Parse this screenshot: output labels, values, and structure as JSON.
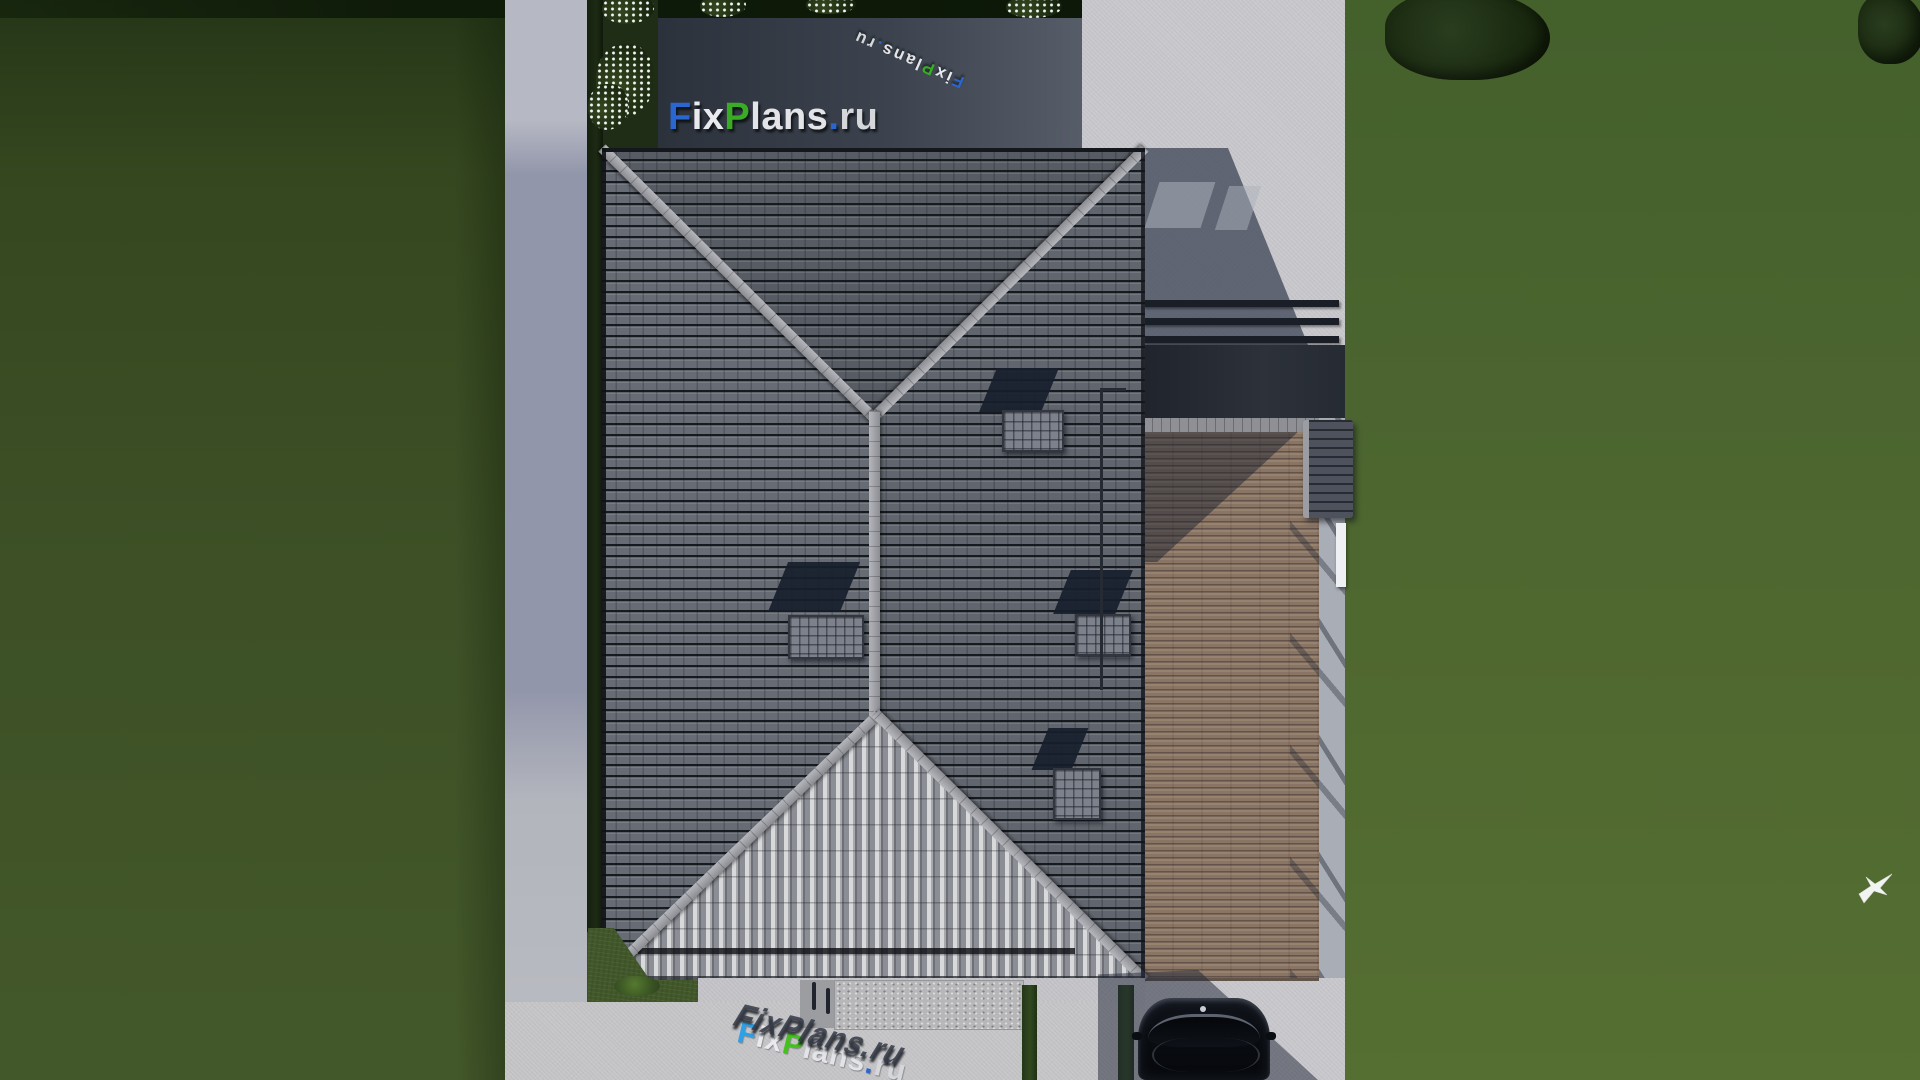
{
  "brand": {
    "name": "FixPlans.ru",
    "parts": [
      {
        "text": "F",
        "color": "#2a66cf"
      },
      {
        "text": "ix",
        "color": "#e9eaee"
      },
      {
        "text": "P",
        "color": "#3aab24"
      },
      {
        "text": "lans",
        "color": "#e3e4e8"
      },
      {
        "text": ".",
        "color": "#2a66cf"
      },
      {
        "text": "ru",
        "color": "#d6d7db"
      }
    ],
    "accent_blue": "#2a66cf",
    "accent_green": "#3aab24"
  },
  "scene": {
    "description": "Aerial top-down 3D render of a single-family house plan with hipped tile roof, side wooden terrace, stone patios, concrete walkways, driveway with parked car, lawns, flowering shrubs and a flying bird",
    "objects": [
      "hipped-tile-roof",
      "roof-windows",
      "roof-ridge-caps",
      "roof-drain-pipe",
      "wooden-terrace",
      "terrace-railing",
      "entry-awning",
      "pergola-beams",
      "stone-patio-top",
      "stone-patio-side",
      "concrete-sidewalk",
      "concrete-apron",
      "stamped-stone-path",
      "driveway",
      "parked-car",
      "lawn",
      "hedges",
      "flowering-shrubs",
      "tree-foliage",
      "flying-bird",
      "cast-shadows"
    ],
    "materials": {
      "roof_tiles": "#61666f",
      "roof_sunlit_slope": "#c9cacd",
      "ridge_caps": "#9fa0a6",
      "deck_wood": "#8a7565",
      "stone_patio": "#3a404b",
      "concrete": "#c9c9cd",
      "sidewalk_shaded": "#9296aa",
      "lawn_shaded": "#3c4f27",
      "lawn_sunlit": "#4d6530",
      "car_body": "#0a0d12"
    }
  }
}
